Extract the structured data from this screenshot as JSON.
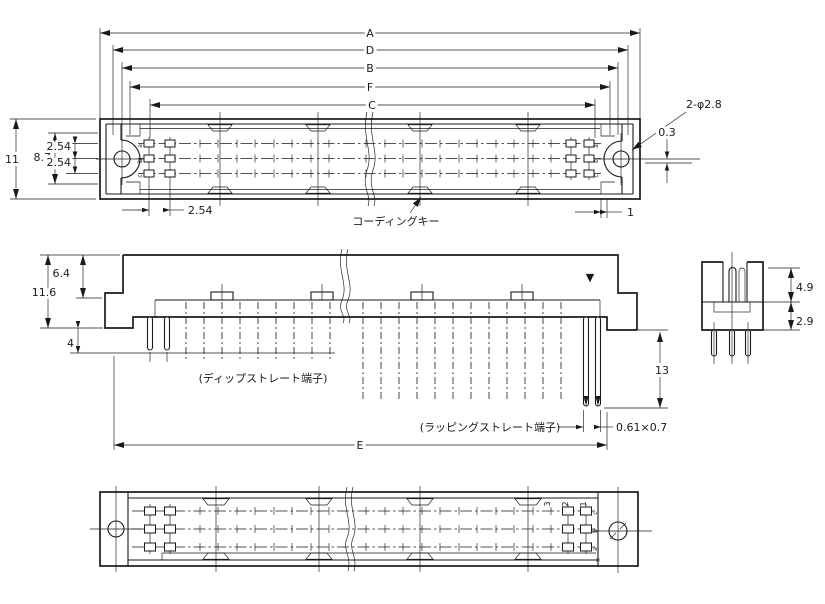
{
  "colors": {
    "line": "#1a1a1a",
    "background": "#ffffff"
  },
  "top_view": {
    "dims": {
      "a": "A",
      "d": "D",
      "b": "B",
      "f": "F",
      "c": "C",
      "height": "11",
      "row_span": "8.7",
      "row_pitch_upper": "2.54",
      "row_pitch_lower": "2.54",
      "holes": "2-φ2.8",
      "center_offset": "0.3",
      "end_gap": "1",
      "column_pitch": "2.54"
    },
    "coding_key": "コーディングキー",
    "rows": {
      "a": "a",
      "b": "b",
      "c": "c"
    }
  },
  "front_view": {
    "dims": {
      "upper_height": "6.4",
      "total_height": "11.6",
      "standoff": "4",
      "wrap_pin_length": "13",
      "length": "E",
      "pin_cross_section": "0.61×0.7"
    },
    "dip_terminal_label": "(ディップストレート端子)",
    "wrap_terminal_label": "(ラッピングストレート端子)",
    "index_mark": "▼"
  },
  "side_view": {
    "dims": {
      "upper": "4.9",
      "lower": "2.9"
    }
  },
  "bottom_view": {
    "pin_numbers": {
      "n3": "3",
      "n2": "2",
      "n1": "1"
    },
    "rows": {
      "top": "c",
      "mid": "b",
      "bottom": "a"
    },
    "reference_mark": "※"
  }
}
